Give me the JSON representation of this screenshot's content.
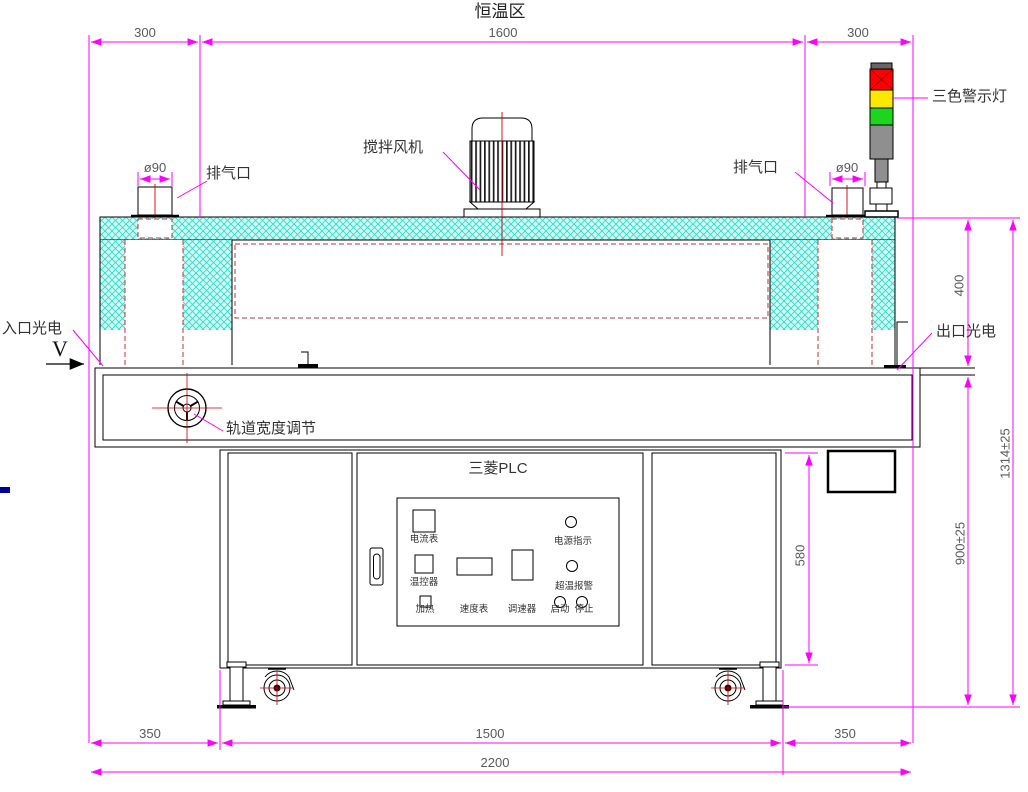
{
  "drawing": {
    "title": "恒温区",
    "plc_label": "三菱PLC",
    "direction_label": "V"
  },
  "annotations": {
    "warning_light": "三色警示灯",
    "exhaust_left": "排气口",
    "exhaust_right": "排气口",
    "stirring_fan": "搅拌风机",
    "inlet_sensor": "入口光电",
    "outlet_sensor": "出口光电",
    "track_width_adjust": "轨道宽度调节"
  },
  "dimensions": {
    "top": [
      "300",
      "1600",
      "300"
    ],
    "exhaust_left_dia": "ø90",
    "exhaust_right_dia": "ø90",
    "oven_height": "400",
    "cabinet_height": "580",
    "table_height": "900±25",
    "total_height": "1314±25",
    "bottom": [
      "350",
      "1500",
      "350"
    ],
    "total_width": "2200"
  },
  "panel": {
    "ammeter": "电流表",
    "power_indicator": "电源指示",
    "temp_controller": "温控器",
    "heating": "加热",
    "speedometer": "速度表",
    "speed_regulator": "调速器",
    "overtemp_alarm": "超温报警",
    "start": "启动",
    "stop": "停止"
  },
  "colors": {
    "dimension_line": "#FF00FF",
    "hidden_line": "#C23030",
    "center_line": "#CC0000",
    "hatch_fill": "#CFFCF4",
    "hatch_line": "#35D9C8",
    "warn_red": "#FF0000",
    "warn_yellow": "#FFE800",
    "warn_green": "#1FD41F",
    "warn_gray": "#8F8F8F",
    "stray_blue": "#00009C"
  }
}
